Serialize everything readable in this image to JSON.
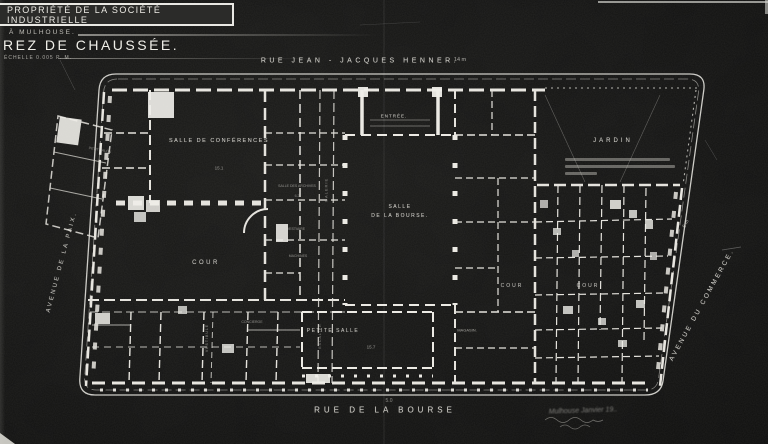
{
  "title_block": {
    "line1": "PROPRIÉTÉ DE LA SOCIÉTÉ INDUSTRIELLE",
    "line2": "À MULHOUSE.",
    "line3": "REZ DE CHAUSSÉE.",
    "scale": "ÉCHELLE 0.005 P. M."
  },
  "streets": {
    "top": {
      "name": "RUE  JEAN - JACQUES  HENNER.",
      "dim": "14 m"
    },
    "bottom": {
      "name": "RUE   DE  LA   BOURSE",
      "dim": "5.0"
    },
    "left": {
      "name": "AVENUE  DE  LA  PAIX."
    },
    "right": {
      "name": "AVENUE  DU  COMMERCE.",
      "dim": "6 m"
    }
  },
  "rooms": {
    "salle_conferences": {
      "label": "SALLE DE CONFÉRENCES",
      "dim": "15.1"
    },
    "entree": "ENTRÉE.",
    "salle_bourse_1": "SALLE",
    "salle_bourse_2": "DE LA BOURSE.",
    "petite_salle": {
      "label": "PETITE SALLE",
      "dim": "15.7"
    },
    "jardin": "JARDIN",
    "cour_left": "COUR",
    "cour_mid": "COUR",
    "cour_right": "COUR",
    "magasin": "MAGASIN.",
    "archives": "SALLE DES ARCHIVES",
    "archives_dim": "6.2",
    "vestiaire": "VESTIAIRE",
    "machines": "MACHINES",
    "galerie": "GALERIE",
    "escalier": "ESCALIER",
    "vestibule": "VESTIBULE",
    "concierge": "CONCIERGE",
    "petit_salon": "PETIT SALON"
  },
  "annotations": {
    "handwritten": "Mulhouse Janvier 19.."
  }
}
